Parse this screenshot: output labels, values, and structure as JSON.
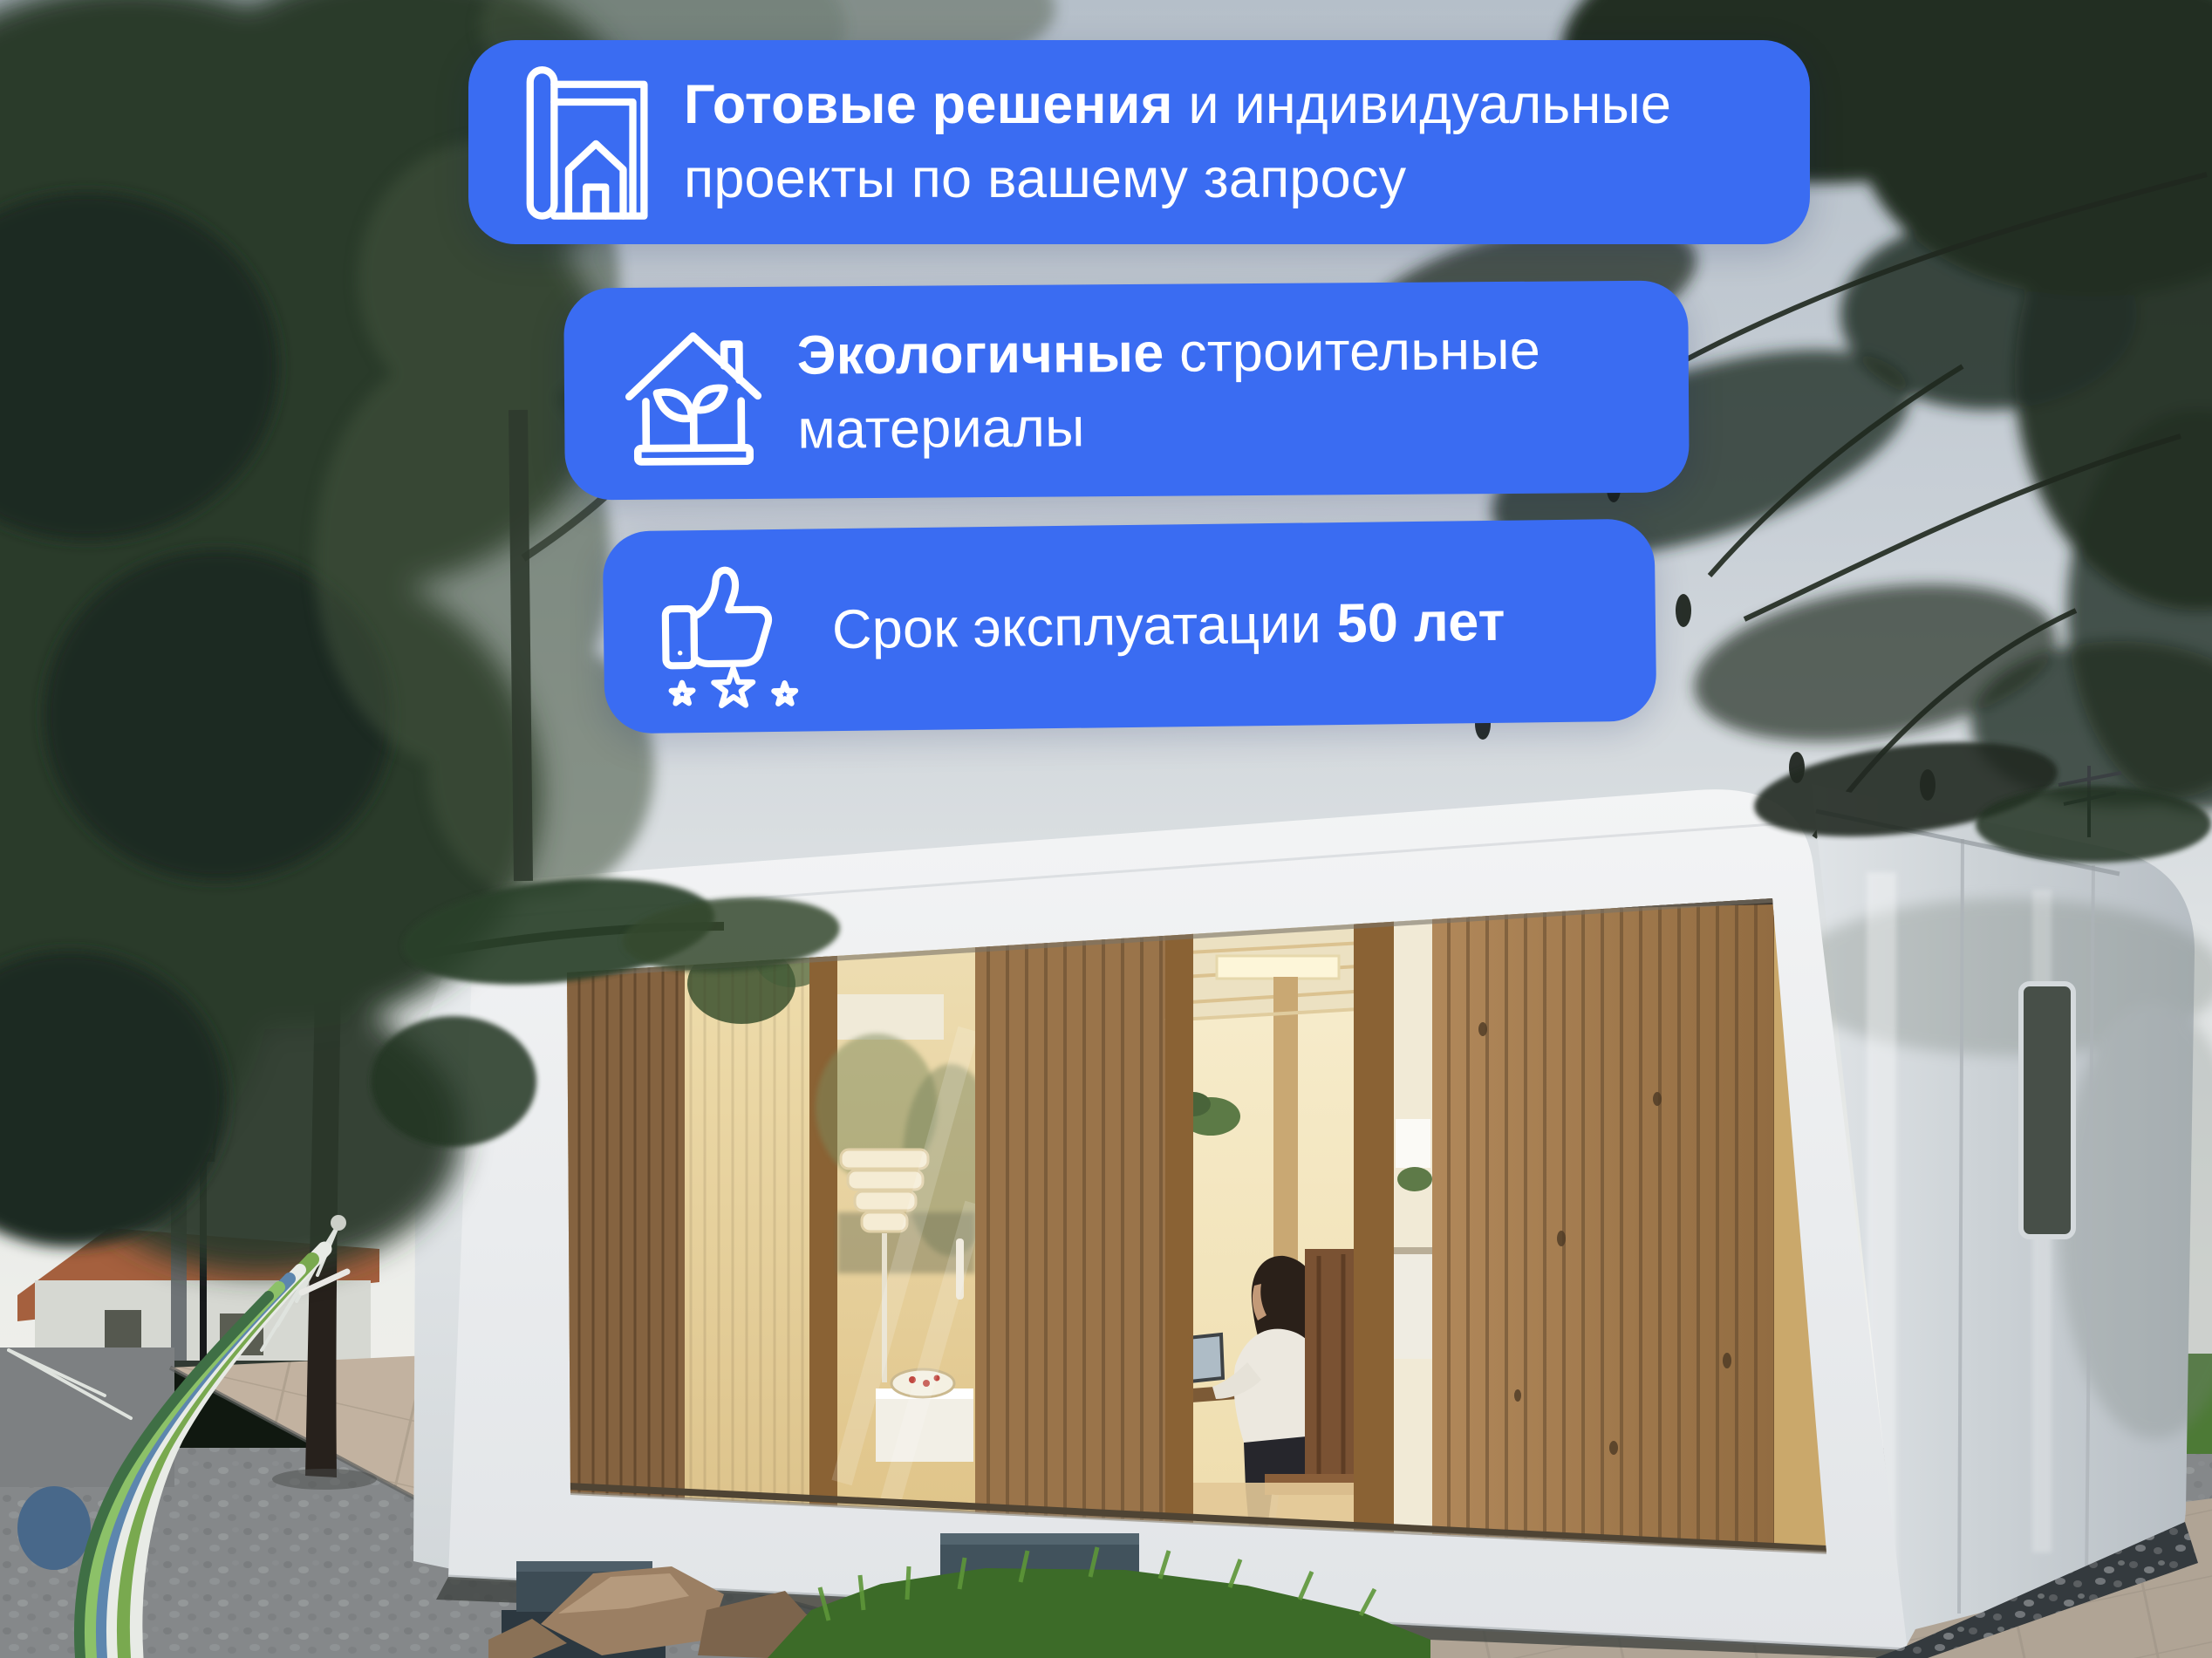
{
  "colors": {
    "badge_blue": "#3A6CF2",
    "badge_text": "#FFFFFF",
    "icon_stroke": "#FFFFFF"
  },
  "scene": {
    "alt": "Dusk photo: white modular prefab house with wooden slat facade and warm lit interior, woman working at a desk, pine trees, hammock, street lamp, paved path and gravel yard"
  },
  "badges": [
    {
      "icon": "blueprint-icon",
      "line1_bold": "Готовые решения",
      "line1_rest": " и индивидуальные",
      "line2": "проекты по вашему запросу"
    },
    {
      "icon": "eco-house-icon",
      "line1_bold": "Экологичные",
      "line1_rest": " строительные",
      "line2": "материалы"
    },
    {
      "icon": "thumbs-up-stars-icon",
      "line1_start": "Срок эксплуатации ",
      "line1_bold": "50 лет"
    }
  ]
}
